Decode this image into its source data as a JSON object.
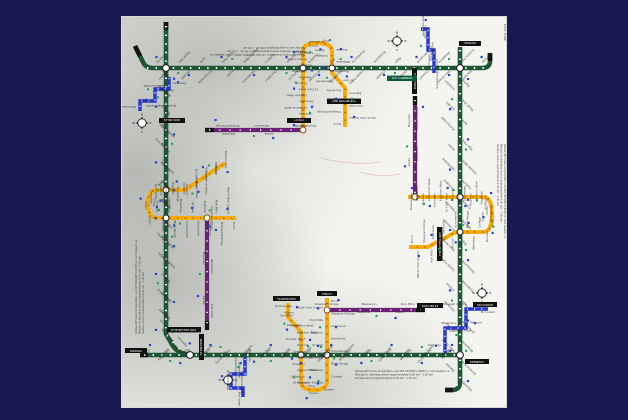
{
  "frame": {
    "background_color": "#181852"
  },
  "map": {
    "paper_color": "#f4f5f1",
    "description": "Toronto TTC subway/RT route map printed four times, rotated 0/90/180/270 degrees into a square ring on watercolour-washed paper",
    "slogan_box": "THE BETTER WAY",
    "go_box": "KENNEDY GO",
    "district_label": "EAST YORK",
    "compass": {
      "n": "N",
      "e": "E",
      "s": "S",
      "w": "W"
    },
    "fine_print": {
      "line1": "Subway/RT hours of operation: call 416 393-INFO (4636) or visit www.ttc.ca",
      "line2": "Monday to Saturday service approximately 6:00 am - 1:30 am",
      "line3": "Sunday service approximately 9:00 am - 1:30 am"
    },
    "terminals": {
      "kipling": "KIPLING",
      "kennedy": "KENNEDY",
      "finch": "FINCH",
      "downsview": "DOWNSVIEW",
      "don_mills": "DON MILLS",
      "mccowan": "McCOWAN"
    },
    "lines": [
      {
        "id": "bloor-danforth",
        "name": "Bloor-Danforth line",
        "color": "#1c5632",
        "stations": [
          "Kipling",
          "Islington",
          "Royal York",
          "Old Mill",
          "Jane",
          "Runnymede",
          "High Park",
          "Keele",
          "Dundas West",
          "Lansdowne",
          "Dufferin",
          "Ossington",
          "Christie",
          "Bathurst",
          "Spadina",
          "St George",
          "Bay",
          "Bloor-Yonge",
          "Sherbourne",
          "Castle Frank",
          "Broadview",
          "Chester",
          "Pape",
          "Donlands",
          "Greenwood",
          "Coxwell",
          "Woodbine",
          "Main Street",
          "Victoria Park",
          "Warden",
          "Kennedy"
        ]
      },
      {
        "id": "yonge-university",
        "name": "Yonge-University-Spadina line",
        "color": "#f3ac0c",
        "stations": [
          "Downsview",
          "Wilson",
          "Yorkdale",
          "Lawrence West",
          "Glencairn",
          "Eglinton West",
          "St Clair West",
          "Dupont",
          "Spadina",
          "St George",
          "Museum",
          "Queen's Park",
          "St Patrick",
          "Osgoode",
          "St Andrew",
          "Union",
          "King",
          "Queen",
          "Dundas",
          "College",
          "Wellesley",
          "Bloor-Yonge",
          "Rosedale",
          "Summerhill",
          "St Clair",
          "Davisville",
          "Eglinton",
          "Lawrence",
          "York Mills",
          "Sheppard-Yonge",
          "North York Centre",
          "Finch"
        ]
      },
      {
        "id": "sheppard",
        "name": "Sheppard line",
        "color": "#6b2173",
        "stations": [
          "Sheppard-Yonge",
          "Bayview",
          "Bessarion",
          "Leslie",
          "Don Mills"
        ]
      },
      {
        "id": "scarborough-rt",
        "name": "Scarborough RT",
        "color": "#2636cf",
        "stations": [
          "Kennedy",
          "Lawrence East",
          "Ellesmere",
          "Midland",
          "Scarborough Centre",
          "McCowan"
        ]
      }
    ]
  }
}
